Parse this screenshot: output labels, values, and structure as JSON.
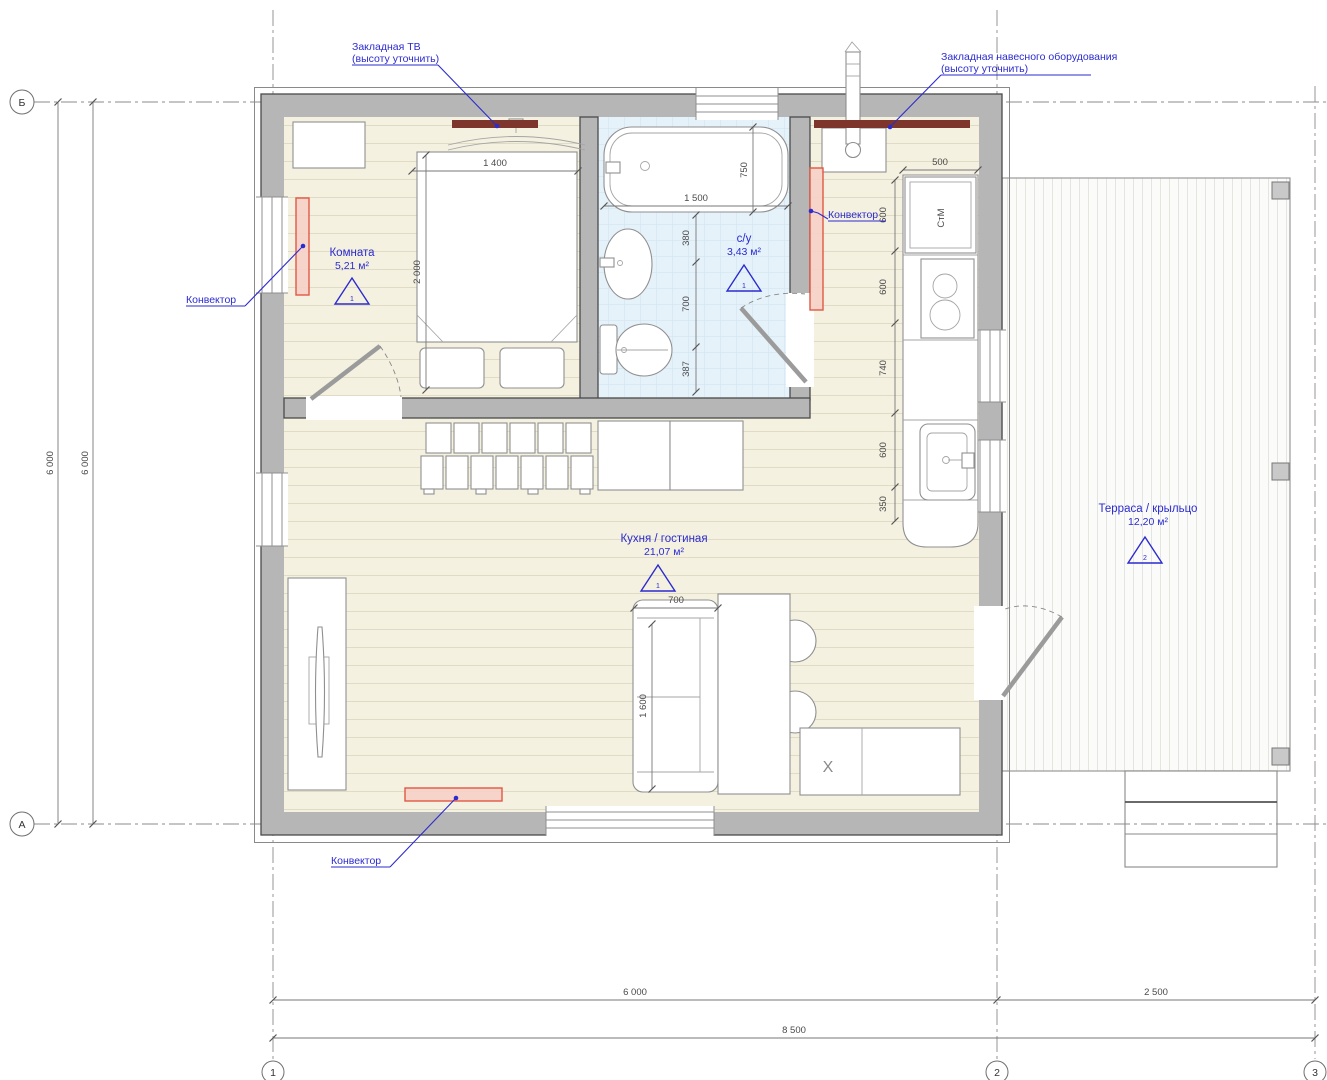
{
  "annotations": {
    "tv_embed_line1": "Закладная ТВ",
    "tv_embed_line2": "(высоту уточнить)",
    "equipment_line1": "Закладная навесного оборудования",
    "equipment_line2": "(высоту уточнить)",
    "convector": "Конвектор"
  },
  "rooms": {
    "bedroom": {
      "name": "Комната",
      "area": "5,21 м²",
      "marker": "1"
    },
    "bathroom": {
      "name": "с/у",
      "area": "3,43 м²",
      "marker": "1"
    },
    "kitchen_living": {
      "name": "Кухня / гостиная",
      "area": "21,07 м²",
      "marker": "1"
    },
    "terrace": {
      "name": "Терраса / крыльцо",
      "area": "12,20 м²",
      "marker": "2"
    }
  },
  "equipment": {
    "washing_machine": "СтМ",
    "cabinet_mark": "X"
  },
  "dimensions": {
    "bed_width": "1 400",
    "bed_length": "2 000",
    "bath_length": "1 500",
    "bath_width": "750",
    "wc_chain": [
      "380",
      "700",
      "387"
    ],
    "kitchen_top": "500",
    "kitchen_chain": [
      "600",
      "600",
      "740",
      "600",
      "350"
    ],
    "sofa_width": "700",
    "sofa_length": "1 600",
    "left_outer": "6 000",
    "left_inner": "6 000",
    "bottom_1_2": "6 000",
    "bottom_2_3": "2 500",
    "bottom_total": "8 500"
  },
  "grid_axes": {
    "row_top": "Б",
    "row_bottom": "А",
    "col_left": "1",
    "col_mid": "2",
    "col_right": "3"
  },
  "colors": {
    "annotation_blue": "#2b2bd0",
    "wall_gray": "#b6b6b6",
    "floor_beige": "#f4f1e1",
    "tile_blue": "#e6f2fa",
    "convector_red": "#e05844",
    "embed_red": "#7e352b"
  }
}
